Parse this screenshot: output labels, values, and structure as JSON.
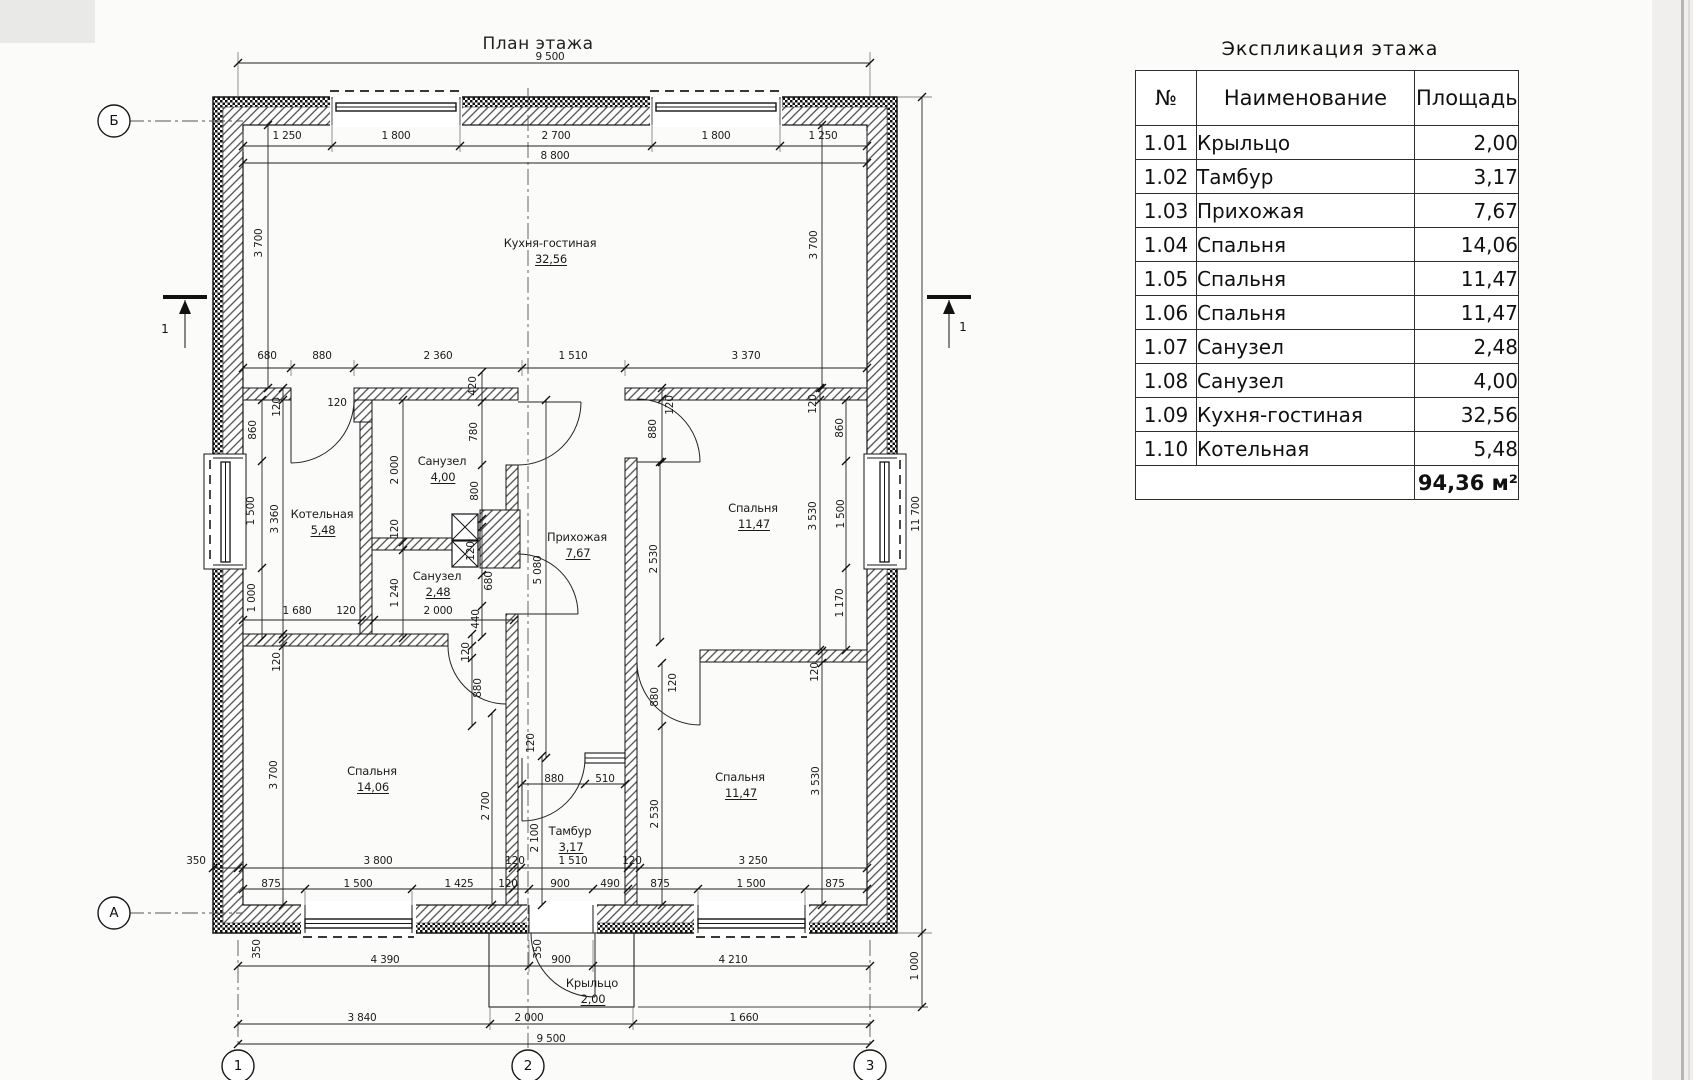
{
  "plan": {
    "title": "План этажа",
    "rooms": [
      {
        "name": "Кухня-гостиная",
        "area": "32,56",
        "x": 550,
        "y": 243
      },
      {
        "name": "Котельная",
        "area": "5,48",
        "x": 322,
        "y": 514
      },
      {
        "name": "Санузел",
        "area": "4,00",
        "x": 442,
        "y": 461
      },
      {
        "name": "Санузел",
        "area": "2,48",
        "x": 437,
        "y": 576
      },
      {
        "name": "Прихожая",
        "area": "7,67",
        "x": 577,
        "y": 537
      },
      {
        "name": "Спальня",
        "area": "11,47",
        "x": 753,
        "y": 508
      },
      {
        "name": "Спальня",
        "area": "14,06",
        "x": 372,
        "y": 771
      },
      {
        "name": "Спальня",
        "area": "11,47",
        "x": 740,
        "y": 777
      },
      {
        "name": "Тамбур",
        "area": "3,17",
        "x": 570,
        "y": 831
      },
      {
        "name": "Крыльцо",
        "area": "2,00",
        "x": 592,
        "y": 983
      }
    ],
    "dims": [
      {
        "t": "9 500",
        "x": 550,
        "y": 57
      },
      {
        "t": "1 250",
        "x": 287,
        "y": 136
      },
      {
        "t": "1 800",
        "x": 396,
        "y": 136
      },
      {
        "t": "2 700",
        "x": 556,
        "y": 136
      },
      {
        "t": "1 800",
        "x": 716,
        "y": 136
      },
      {
        "t": "1 250",
        "x": 823,
        "y": 136
      },
      {
        "t": "8 800",
        "x": 555,
        "y": 156
      },
      {
        "t": "680",
        "x": 267,
        "y": 356
      },
      {
        "t": "880",
        "x": 322,
        "y": 356
      },
      {
        "t": "2 360",
        "x": 438,
        "y": 356
      },
      {
        "t": "1 510",
        "x": 573,
        "y": 356
      },
      {
        "t": "3 370",
        "x": 746,
        "y": 356
      },
      {
        "t": "3 700",
        "x": 259,
        "y": 243,
        "v": 1
      },
      {
        "t": "3 700",
        "x": 814,
        "y": 245,
        "v": 1
      },
      {
        "t": "120",
        "x": 277,
        "y": 407,
        "v": 1
      },
      {
        "t": "860",
        "x": 253,
        "y": 430,
        "v": 1
      },
      {
        "t": "1 500",
        "x": 251,
        "y": 511,
        "v": 1
      },
      {
        "t": "1 000",
        "x": 252,
        "y": 598,
        "v": 1
      },
      {
        "t": "3 360",
        "x": 275,
        "y": 519,
        "v": 1
      },
      {
        "t": "120",
        "x": 337,
        "y": 403
      },
      {
        "t": "2 000",
        "x": 395,
        "y": 470,
        "v": 1
      },
      {
        "t": "120",
        "x": 395,
        "y": 529,
        "v": 1
      },
      {
        "t": "1 240",
        "x": 395,
        "y": 593,
        "v": 1
      },
      {
        "t": "420",
        "x": 473,
        "y": 386,
        "v": 1
      },
      {
        "t": "780",
        "x": 474,
        "y": 432,
        "v": 1
      },
      {
        "t": "800",
        "x": 475,
        "y": 491,
        "v": 1
      },
      {
        "t": "120",
        "x": 471,
        "y": 551,
        "v": 1
      },
      {
        "t": "680",
        "x": 489,
        "y": 581,
        "v": 1
      },
      {
        "t": "440",
        "x": 476,
        "y": 619,
        "v": 1
      },
      {
        "t": "1 680",
        "x": 297,
        "y": 611
      },
      {
        "t": "120",
        "x": 346,
        "y": 611
      },
      {
        "t": "2 000",
        "x": 438,
        "y": 611
      },
      {
        "t": "5 080",
        "x": 538,
        "y": 570,
        "v": 1
      },
      {
        "t": "120",
        "x": 670,
        "y": 405,
        "v": 1
      },
      {
        "t": "880",
        "x": 653,
        "y": 429,
        "v": 1
      },
      {
        "t": "120",
        "x": 813,
        "y": 404,
        "v": 1
      },
      {
        "t": "3 530",
        "x": 813,
        "y": 516,
        "v": 1
      },
      {
        "t": "860",
        "x": 840,
        "y": 428,
        "v": 1
      },
      {
        "t": "1 500",
        "x": 841,
        "y": 514,
        "v": 1
      },
      {
        "t": "1 170",
        "x": 840,
        "y": 603,
        "v": 1
      },
      {
        "t": "2 530",
        "x": 654,
        "y": 559,
        "v": 1
      },
      {
        "t": "120",
        "x": 466,
        "y": 652,
        "v": 1
      },
      {
        "t": "880",
        "x": 478,
        "y": 688,
        "v": 1
      },
      {
        "t": "120",
        "x": 277,
        "y": 662,
        "v": 1
      },
      {
        "t": "3 700",
        "x": 274,
        "y": 775,
        "v": 1
      },
      {
        "t": "2 700",
        "x": 486,
        "y": 806,
        "v": 1
      },
      {
        "t": "120",
        "x": 531,
        "y": 743,
        "v": 1
      },
      {
        "t": "880",
        "x": 554,
        "y": 779
      },
      {
        "t": "510",
        "x": 605,
        "y": 779
      },
      {
        "t": "2 100",
        "x": 535,
        "y": 838,
        "v": 1
      },
      {
        "t": "880",
        "x": 655,
        "y": 697,
        "v": 1
      },
      {
        "t": "120",
        "x": 673,
        "y": 683,
        "v": 1
      },
      {
        "t": "2 530",
        "x": 655,
        "y": 814,
        "v": 1
      },
      {
        "t": "120",
        "x": 815,
        "y": 672,
        "v": 1
      },
      {
        "t": "3 530",
        "x": 816,
        "y": 781,
        "v": 1
      },
      {
        "t": "350",
        "x": 196,
        "y": 861
      },
      {
        "t": "3 800",
        "x": 378,
        "y": 861
      },
      {
        "t": "120",
        "x": 515,
        "y": 861
      },
      {
        "t": "1 510",
        "x": 573,
        "y": 861
      },
      {
        "t": "120",
        "x": 632,
        "y": 861
      },
      {
        "t": "3 250",
        "x": 753,
        "y": 861
      },
      {
        "t": "875",
        "x": 271,
        "y": 884
      },
      {
        "t": "1 500",
        "x": 358,
        "y": 884
      },
      {
        "t": "1 425",
        "x": 459,
        "y": 884
      },
      {
        "t": "120",
        "x": 508,
        "y": 884
      },
      {
        "t": "900",
        "x": 560,
        "y": 884
      },
      {
        "t": "490",
        "x": 610,
        "y": 884
      },
      {
        "t": "875",
        "x": 660,
        "y": 884
      },
      {
        "t": "1 500",
        "x": 751,
        "y": 884
      },
      {
        "t": "875",
        "x": 835,
        "y": 884
      },
      {
        "t": "350",
        "x": 257,
        "y": 949,
        "v": 1
      },
      {
        "t": "350",
        "x": 538,
        "y": 949,
        "v": 1
      },
      {
        "t": "4 390",
        "x": 385,
        "y": 960
      },
      {
        "t": "900",
        "x": 561,
        "y": 960
      },
      {
        "t": "4 210",
        "x": 733,
        "y": 960
      },
      {
        "t": "3 840",
        "x": 362,
        "y": 1018
      },
      {
        "t": "2 000",
        "x": 529,
        "y": 1018
      },
      {
        "t": "1 660",
        "x": 744,
        "y": 1018
      },
      {
        "t": "9 500",
        "x": 551,
        "y": 1039
      },
      {
        "t": "11 700",
        "x": 916,
        "y": 514,
        "v": 1
      },
      {
        "t": "1 000",
        "x": 915,
        "y": 966,
        "v": 1
      }
    ],
    "axes": [
      {
        "label": "Б",
        "x": 114,
        "y": 121
      },
      {
        "label": "А",
        "x": 114,
        "y": 913
      },
      {
        "label": "1",
        "x": 238,
        "y": 1066
      },
      {
        "label": "2",
        "x": 528,
        "y": 1066
      },
      {
        "label": "3",
        "x": 870,
        "y": 1066
      }
    ],
    "sections": [
      {
        "label": "1",
        "x": 165,
        "y": 329
      },
      {
        "label": "1",
        "x": 963,
        "y": 327
      }
    ]
  },
  "table": {
    "title": "Экспликация  этажа",
    "columns": [
      "№",
      "Наименование",
      "Площадь"
    ],
    "rows": [
      [
        "1.01",
        "Крыльцо",
        "2,00"
      ],
      [
        "1.02",
        "Тамбур",
        "3,17"
      ],
      [
        "1.03",
        "Прихожая",
        "7,67"
      ],
      [
        "1.04",
        "Спальня",
        "14,06"
      ],
      [
        "1.05",
        "Спальня",
        "11,47"
      ],
      [
        "1.06",
        "Спальня",
        "11,47"
      ],
      [
        "1.07",
        "Санузел",
        "2,48"
      ],
      [
        "1.08",
        "Санузел",
        "4,00"
      ],
      [
        "1.09",
        "Кухня-гостиная",
        "32,56"
      ],
      [
        "1.10",
        "Котельная",
        "5,48"
      ]
    ],
    "total": "94,36 м²"
  }
}
